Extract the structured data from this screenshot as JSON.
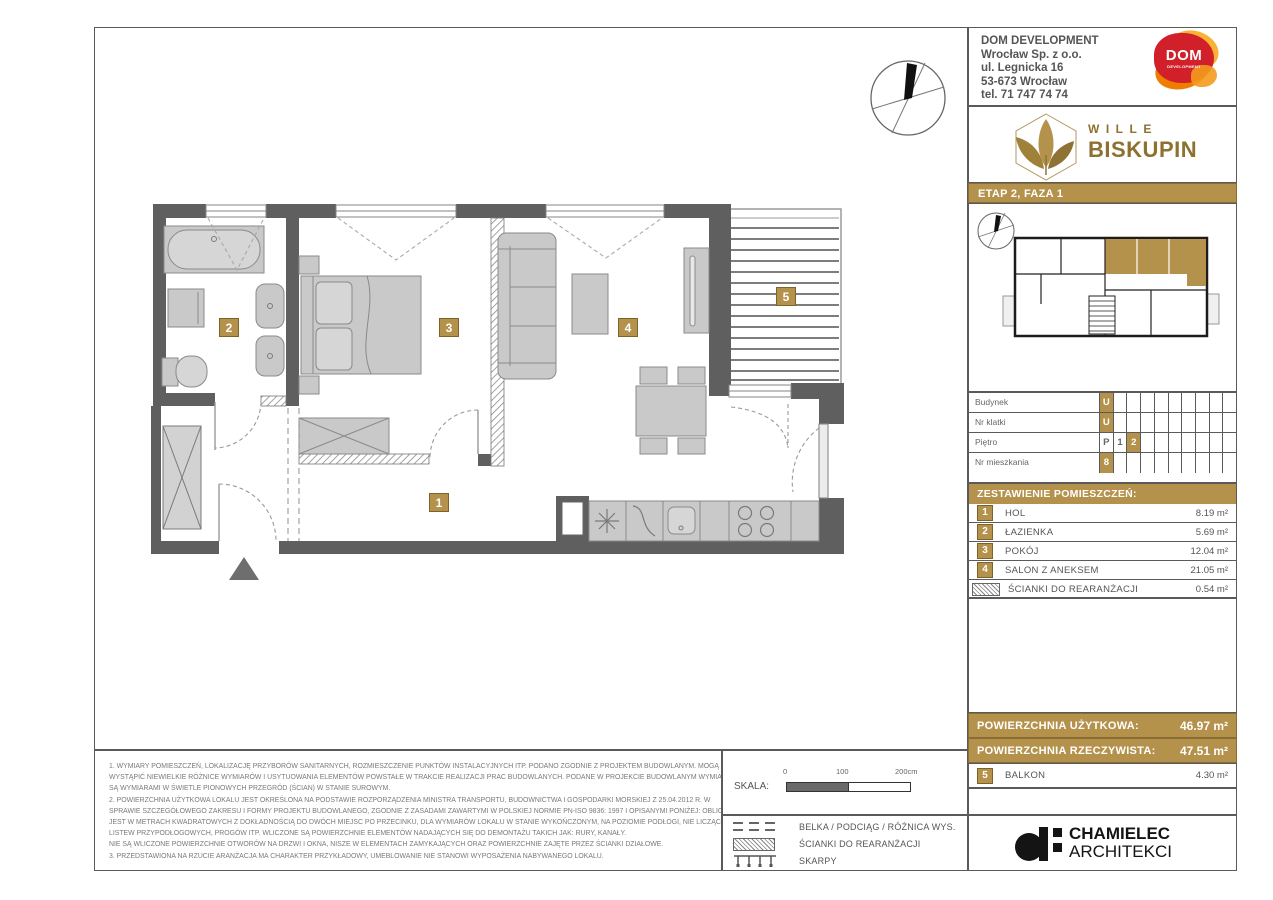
{
  "company": {
    "name": "DOM DEVELOPMENT",
    "address_line1": "Wrocław Sp. z o.o.",
    "address_line2": "ul. Legnicka 16",
    "address_line3": "53-673 Wrocław",
    "address_line4": "tel. 71 747 74 74",
    "logo_text": "DOM",
    "logo_sub": "DEVELOPMENT"
  },
  "brand": {
    "word1": "WILLE",
    "word2": "BISKUPIN"
  },
  "phase_bar": "ETAP 2, FAZA 1",
  "unit_info": {
    "rows": [
      {
        "label": "Budynek",
        "values": [
          "U"
        ],
        "highlight_index": 0
      },
      {
        "label": "Nr klatki",
        "values": [
          "U"
        ],
        "highlight_index": 0
      },
      {
        "label": "Piętro",
        "values": [
          "P",
          "1",
          "2"
        ],
        "highlight_index": 2
      },
      {
        "label": "Nr mieszkania",
        "values": [
          "8"
        ],
        "highlight_index": 0
      }
    ]
  },
  "rooms": {
    "header": "ZESTAWIENIE POMIESZCZEŃ:",
    "items": [
      {
        "num": "1",
        "name": "HOL",
        "area": "8.19 m²"
      },
      {
        "num": "2",
        "name": "ŁAZIENKA",
        "area": "5.69 m²"
      },
      {
        "num": "3",
        "name": "POKÓJ",
        "area": "12.04 m²"
      },
      {
        "num": "4",
        "name": "SALON Z ANEKSEM",
        "area": "21.05 m²"
      },
      {
        "num": "",
        "name": "ŚCIANKI DO REARANŻACJI",
        "area": "0.54 m²"
      }
    ]
  },
  "summary": {
    "usable_label": "POWIERZCHNIA UŻYTKOWA:",
    "usable_value": "46.97 m²",
    "real_label": "POWIERZCHNIA RZECZYWISTA:",
    "real_value": "47.51 m²",
    "balcony": {
      "num": "5",
      "name": "BALKON",
      "area": "4.30 m²"
    }
  },
  "scale": {
    "label": "SKALA:",
    "tick0": "0",
    "tick1": "100",
    "tick2": "200cm"
  },
  "legend": {
    "items": [
      "BELKA / PODCIĄG / RÓŻNICA WYS.",
      "ŚCIANKI DO REARANŻACJI",
      "SKARPY"
    ]
  },
  "architect": {
    "name_line1": "CHAMIELEC",
    "name_line2": "ARCHITEKCI"
  },
  "plan": {
    "badges": {
      "b1": "1",
      "b2": "2",
      "b3": "3",
      "b4": "4",
      "b5": "5"
    }
  },
  "notes": {
    "lines": [
      "1. WYMIARY POMIESZCZEŃ, LOKALIZACJĘ PRZYBORÓW SANITARNYCH, ROZMIESZCZENIE PUNKTÓW INSTALACYJNYCH ITP. PODANO ZGODNIE Z PROJEKTEM BUDOWLANYM. MOGĄ",
      "WYSTĄPIĆ NIEWIELKIE RÓŻNICE WYMIARÓW I USYTUOWANIA ELEMENTÓW POWSTAŁE W TRAKCIE REALIZACJI PRAC BUDOWLANYCH. PODANE W PROJEKCIE BUDOWLANYM WYMIARY",
      "SĄ WYMIARAMI W ŚWIETLE PIONOWYCH PRZEGRÓD (ŚCIAN) W STANIE SUROWYM.",
      "2. POWIERZCHNIA UŻYTKOWA LOKALU JEST OKREŚLONA NA PODSTAWIE ROZPORZĄDZENIA MINISTRA TRANSPORTU, BUDOWNICTWA I GOSPODARKI MORSKIEJ Z 25.04.2012 R. W",
      "SPRAWIE SZCZEGÓŁOWEGO ZAKRESU I FORMY PROJEKTU BUDOWLANEGO, ZGODNIE Z ZASADAMI ZAWARTYMI W POLSKIEJ NORMIE PN-ISO 9836: 1997 I OPISANYMI PONIŻEJ: OBLICZONA",
      "JEST W METRACH KWADRATOWYCH Z DOKŁADNOŚCIĄ DO DWÓCH MIEJSC PO PRZECINKU, DLA WYMIARÓW LOKALU W STANIE WYKOŃCZONYM, NA POZIOMIE PODŁOGI, NIE LICZĄC",
      "LISTEW PRZYPODŁOGOWYCH, PROGÓW ITP. WLICZONE SĄ POWIERZCHNIE ELEMENTÓW NADAJĄCYCH SIĘ DO DEMONTAŻU TAKICH JAK: RURY, KANAŁY.",
      "NIE SĄ WLICZONE POWIERZCHNIE OTWORÓW NA DRZWI I OKNA, NISZE W ELEMENTACH ZAMYKAJĄCYCH ORAZ POWIERZCHNIE ZAJĘTE PRZEZ ŚCIANKI DZIAŁOWE.",
      "3. PRZEDSTAWIONA NA RZUCIE ARANŻACJA MA CHARAKTER PRZYKŁADOWY, UMEBLOWANIE NIE STANOWI WYPOSAŻENIA NABYWANEGO LOKALU."
    ]
  },
  "colors": {
    "accent_gold": "#b5924c",
    "wall_gray": "#5f5f5f",
    "logo_red": "#d2202a",
    "logo_orange": "#ef7d00",
    "brand_gold": "#8d712f"
  }
}
